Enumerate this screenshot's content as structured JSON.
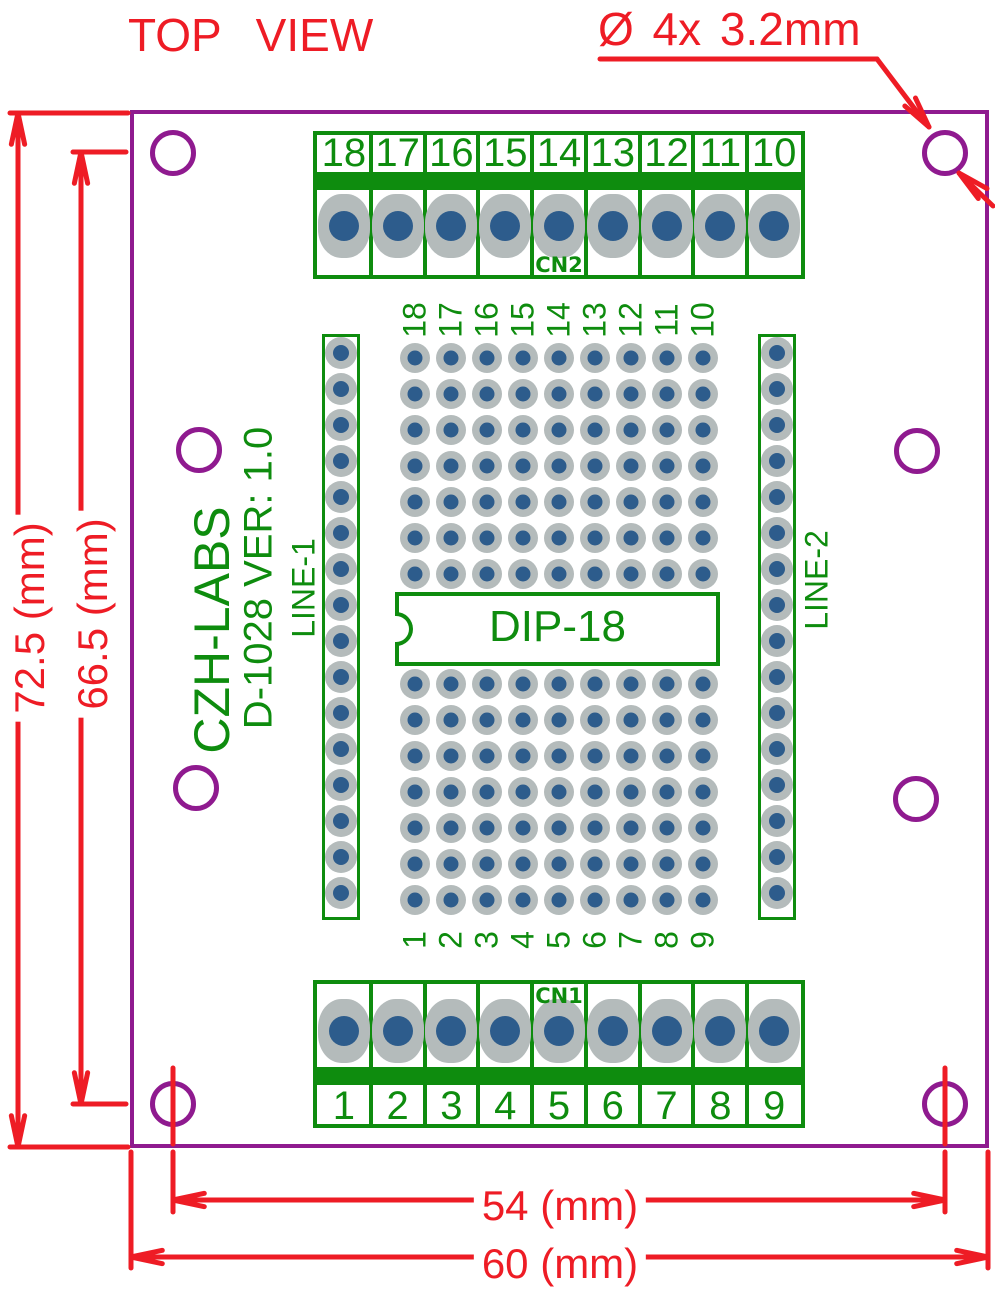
{
  "title": "TOP VIEW",
  "hole_annotation": "Ø 4x  3.2mm",
  "dimensions": {
    "board_height": "72.5 (mm)",
    "hole_span_height": "66.5 (mm)",
    "hole_span_width": "54 (mm)",
    "board_width": "60 (mm)"
  },
  "silkscreen": {
    "brand": "CZH-LABS",
    "model": "D-1028  VER: 1.0",
    "dip_label": "DIP-18",
    "line1_label": "LINE-1",
    "line2_label": "LINE-2"
  },
  "terminals": {
    "top": {
      "name": "CN2",
      "pins": [
        "18",
        "17",
        "16",
        "15",
        "14",
        "13",
        "12",
        "11",
        "10"
      ]
    },
    "bottom": {
      "name": "CN1",
      "pins": [
        "1",
        "2",
        "3",
        "4",
        "5",
        "6",
        "7",
        "8",
        "9"
      ]
    }
  },
  "proto_grid": {
    "top_labels": [
      "18",
      "17",
      "16",
      "15",
      "14",
      "13",
      "12",
      "11",
      "10"
    ],
    "bottom_labels": [
      "1",
      "2",
      "3",
      "4",
      "5",
      "6",
      "7",
      "8",
      "9"
    ],
    "columns": 9,
    "rows_upper": 7,
    "rows_lower": 7
  },
  "line_strips": {
    "pad_count": 16
  },
  "mounting_holes": {
    "corner_count": 4,
    "mid_count": 4,
    "corner_hole_diameter_label": "3.2mm"
  },
  "colors": {
    "red": "#ee1c25",
    "purple": "#8f1a8f",
    "green": "#0e8c0e",
    "pad_gray": "#b4bbbb",
    "pad_blue": "#2d5c8c"
  }
}
